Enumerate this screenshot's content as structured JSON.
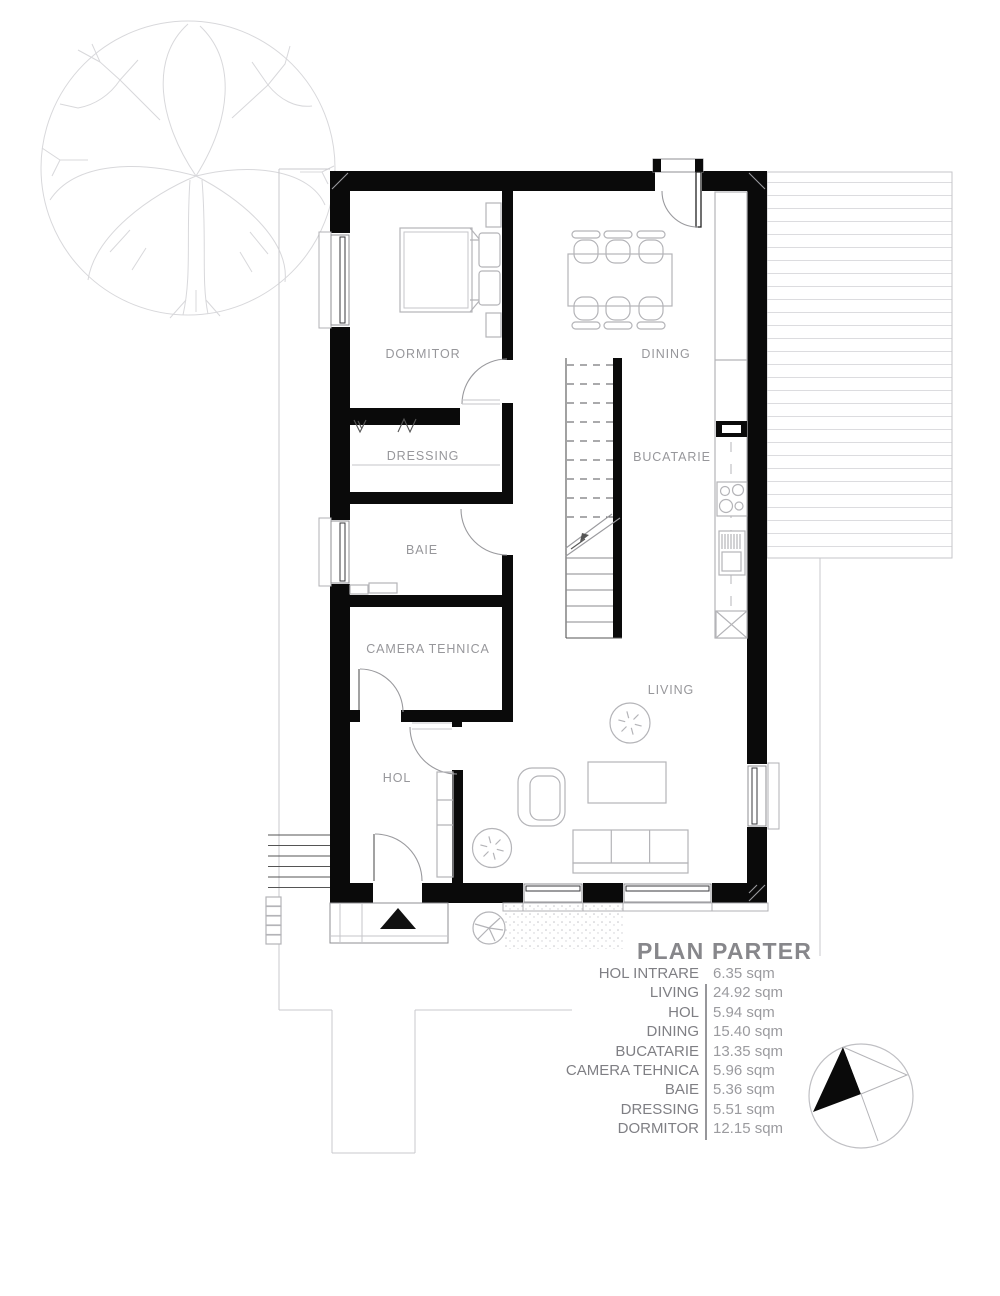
{
  "plan": {
    "title": "PLAN PARTER",
    "rooms": {
      "dormitor": "DORMITOR",
      "dressing": "DRESSING",
      "baie": "BAIE",
      "camera_tehnica": "CAMERA TEHNICA",
      "hol": "HOL",
      "dining": "DINING",
      "bucatarie": "BUCATARIE",
      "living": "LIVING"
    },
    "legend": {
      "rows": [
        {
          "name": "HOL INTRARE",
          "area": "6.35 sqm"
        },
        {
          "name": "LIVING",
          "area": "24.92 sqm"
        },
        {
          "name": "HOL",
          "area": "5.94 sqm"
        },
        {
          "name": "DINING",
          "area": "15.40 sqm"
        },
        {
          "name": "BUCATARIE",
          "area": "13.35 sqm"
        },
        {
          "name": "CAMERA TEHNICA",
          "area": "5.96 sqm"
        },
        {
          "name": "BAIE",
          "area": "5.36 sqm"
        },
        {
          "name": "DRESSING",
          "area": "5.51 sqm"
        },
        {
          "name": "DORMITOR",
          "area": "12.15 sqm"
        }
      ]
    },
    "colors": {
      "wall": "#0a0a0a",
      "room_label": "#97979b",
      "site_line": "#c9c9cd",
      "furniture_line": "#b4b4b8",
      "title": "#87878b"
    },
    "icons": {
      "north_arrow": "north-arrow-icon",
      "entrance_marker": "entrance-triangle-icon",
      "tree": "tree-icon"
    }
  }
}
